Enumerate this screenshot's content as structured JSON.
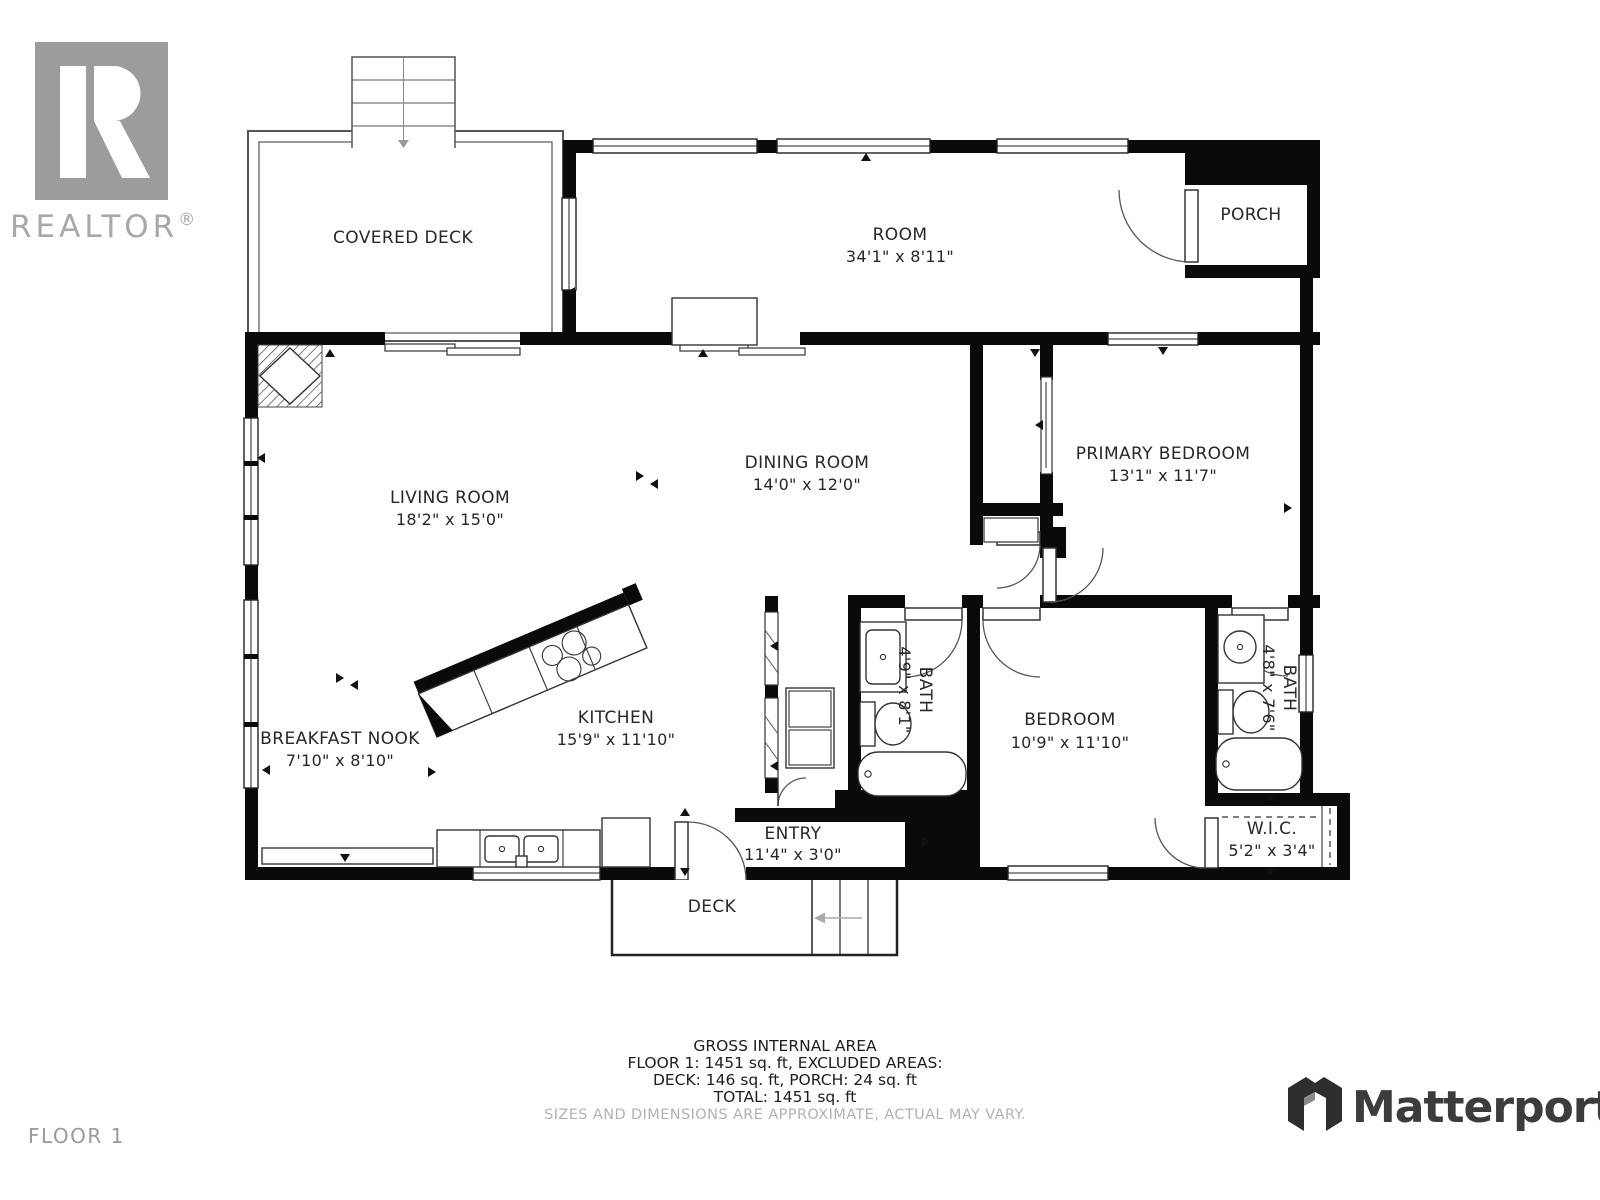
{
  "branding": {
    "realtor_wordmark": "REALTOR",
    "realtor_reg": "®",
    "matterport_wordmark": "Matterport"
  },
  "floor_label": "FLOOR 1",
  "colors": {
    "wall": "#0a0a0a",
    "label": "#272727",
    "muted_gray": "#9a9a9a",
    "disclaimer_gray": "#b2b2b2",
    "realtor_gray": "#9c9c9c",
    "matterport_dark": "#3c3c3c"
  },
  "rooms": [
    {
      "id": "covered-deck",
      "name": "COVERED DECK",
      "dims": ""
    },
    {
      "id": "room",
      "name": "ROOM",
      "dims": "34'1\" x 8'11\""
    },
    {
      "id": "porch",
      "name": "PORCH",
      "dims": ""
    },
    {
      "id": "living-room",
      "name": "LIVING ROOM",
      "dims": "18'2\" x 15'0\""
    },
    {
      "id": "dining-room",
      "name": "DINING ROOM",
      "dims": "14'0\" x 12'0\""
    },
    {
      "id": "primary-bedroom",
      "name": "PRIMARY BEDROOM",
      "dims": "13'1\" x 11'7\""
    },
    {
      "id": "breakfast-nook",
      "name": "BREAKFAST NOOK",
      "dims": "7'10\" x 8'10\""
    },
    {
      "id": "kitchen",
      "name": "KITCHEN",
      "dims": "15'9\" x 11'10\""
    },
    {
      "id": "bath-1",
      "name": "BATH",
      "dims": "4'9\" x 8'1\""
    },
    {
      "id": "bedroom",
      "name": "BEDROOM",
      "dims": "10'9\" x 11'10\""
    },
    {
      "id": "bath-2",
      "name": "BATH",
      "dims": "4'8\" x 7'6\""
    },
    {
      "id": "wic",
      "name": "W.I.C.",
      "dims": "5'2\" x 3'4\""
    },
    {
      "id": "entry",
      "name": "ENTRY",
      "dims": "11'4\" x 3'0\""
    },
    {
      "id": "deck",
      "name": "DECK",
      "dims": ""
    }
  ],
  "summary": {
    "title": "GROSS INTERNAL AREA",
    "line1": "FLOOR 1: 1451 sq. ft, EXCLUDED AREAS:",
    "line2": "DECK: 146 sq. ft, PORCH: 24 sq. ft",
    "line3": "TOTAL: 1451 sq. ft",
    "disclaimer": "SIZES AND DIMENSIONS ARE APPROXIMATE, ACTUAL MAY VARY."
  }
}
